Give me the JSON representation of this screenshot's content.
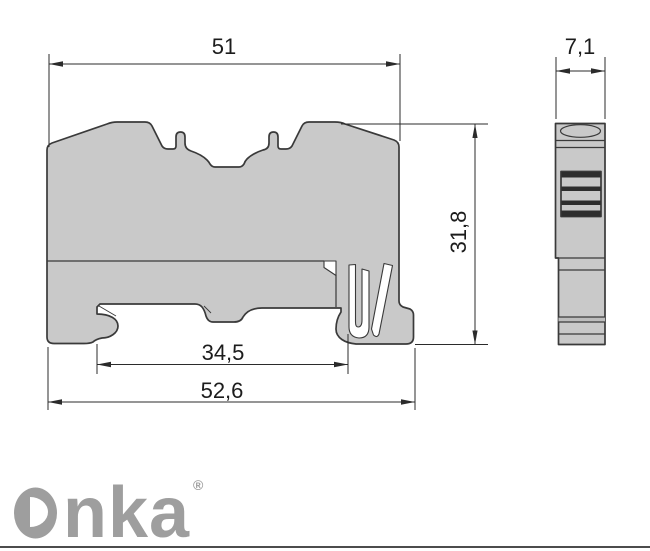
{
  "dimensions": {
    "front_width_top": {
      "label": "51"
    },
    "side_width": {
      "label": "7,1"
    },
    "front_height": {
      "label": "31,8"
    },
    "rail_slot_width": {
      "label": "34,5"
    },
    "front_width_bottom": {
      "label": "52,6"
    }
  },
  "logo": {
    "letters": "nka",
    "registered": "®"
  },
  "colors": {
    "part_fill": "#c9c9c9",
    "outline": "#3a3a3a",
    "dimension_line": "#2b2b2b",
    "logo_gray": "#9e9e9e",
    "bottom_rule": "#4c4c4c"
  }
}
